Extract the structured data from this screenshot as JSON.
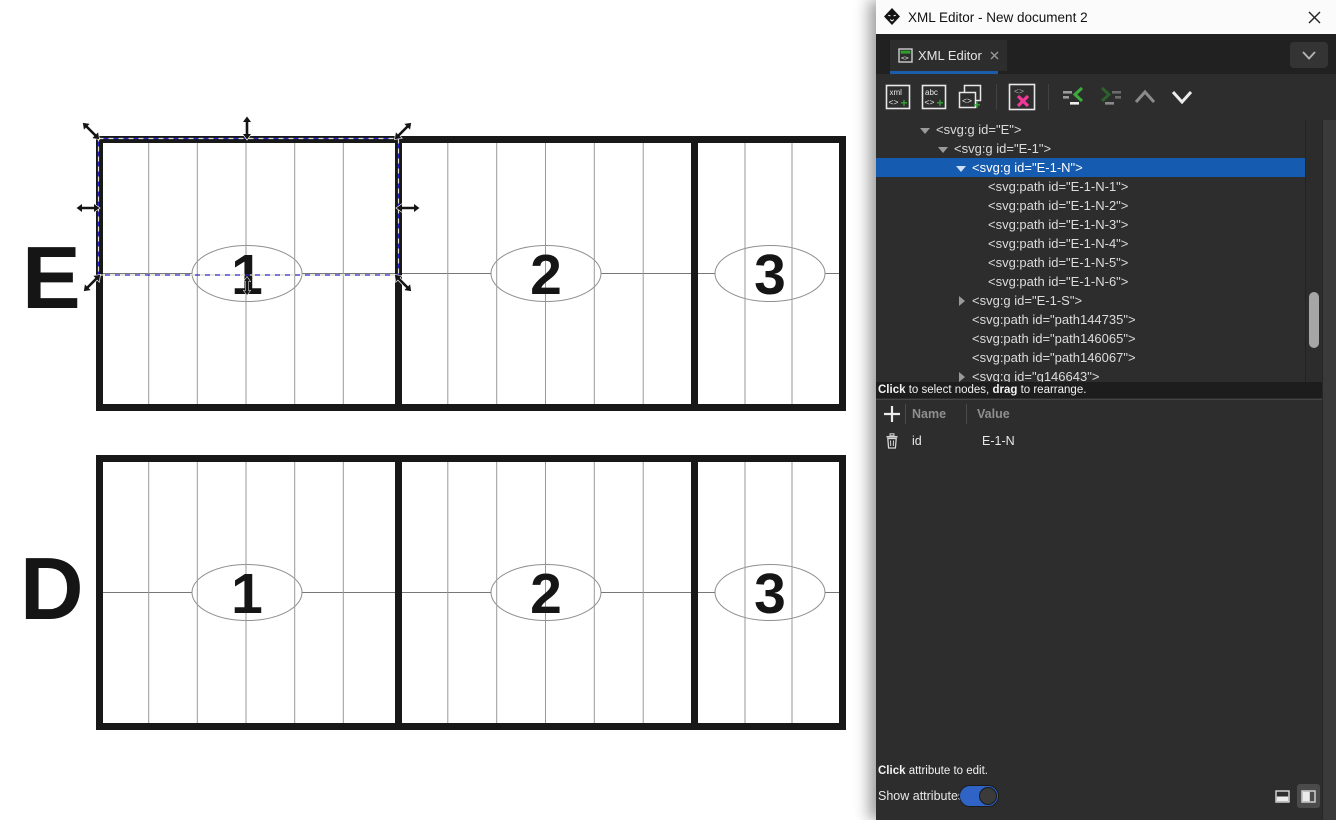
{
  "window": {
    "title": "XML Editor - New document 2"
  },
  "tab": {
    "label": "XML Editor"
  },
  "toolbar": {
    "new_element_text": "xml",
    "new_text_text": "abc",
    "code_glyph": "<>",
    "plus_glyph": "+"
  },
  "tree": {
    "nodes": [
      {
        "label": "<svg:g id=\"E\">",
        "level": 1,
        "expander": "expanded",
        "selected": false
      },
      {
        "label": "<svg:g id=\"E-1\">",
        "level": 2,
        "expander": "expanded",
        "selected": false
      },
      {
        "label": "<svg:g id=\"E-1-N\">",
        "level": 3,
        "expander": "expanded",
        "selected": true
      },
      {
        "label": "<svg:path id=\"E-1-N-1\">",
        "level": 4,
        "expander": "none",
        "selected": false
      },
      {
        "label": "<svg:path id=\"E-1-N-2\">",
        "level": 4,
        "expander": "none",
        "selected": false
      },
      {
        "label": "<svg:path id=\"E-1-N-3\">",
        "level": 4,
        "expander": "none",
        "selected": false
      },
      {
        "label": "<svg:path id=\"E-1-N-4\">",
        "level": 4,
        "expander": "none",
        "selected": false
      },
      {
        "label": "<svg:path id=\"E-1-N-5\">",
        "level": 4,
        "expander": "none",
        "selected": false
      },
      {
        "label": "<svg:path id=\"E-1-N-6\">",
        "level": 4,
        "expander": "none",
        "selected": false
      },
      {
        "label": "<svg:g id=\"E-1-S\">",
        "level": 3,
        "expander": "collapsed",
        "selected": false
      },
      {
        "label": "<svg:path id=\"path144735\">",
        "level": 3,
        "expander": "none",
        "selected": false
      },
      {
        "label": "<svg:path id=\"path146065\">",
        "level": 3,
        "expander": "none",
        "selected": false
      },
      {
        "label": "<svg:path id=\"path146067\">",
        "level": 3,
        "expander": "none",
        "selected": false
      },
      {
        "label": "<svg:g id=\"g146643\">",
        "level": 3,
        "expander": "collapsed",
        "selected": false
      }
    ],
    "hint": {
      "bold1": "Click",
      "text1": " to select nodes, ",
      "bold2": "drag",
      "text2": " to rearrange."
    }
  },
  "attributes": {
    "headers": {
      "name": "Name",
      "value": "Value"
    },
    "rows": [
      {
        "name": "id",
        "value": "E-1-N"
      }
    ],
    "hint": {
      "bold1": "Click",
      "text1": " attribute to edit."
    },
    "show_attributes_label": "Show attributes",
    "show_attributes_on": true
  },
  "canvas": {
    "letters": {
      "top": "E",
      "bottom": "D"
    },
    "section_numbers": [
      "1",
      "2",
      "3"
    ]
  },
  "colors": {
    "selection_blue": "#155bb0",
    "accent_green": "#35a335",
    "delete_pink": "#f2379b",
    "toggle_blue": "#2f63c5",
    "tab_underline": "#1a5dab"
  }
}
